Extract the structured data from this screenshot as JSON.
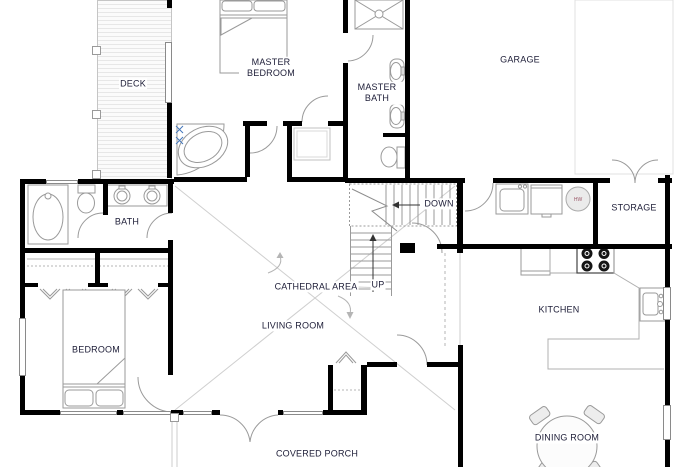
{
  "plan": {
    "type": "residential-floor-plan",
    "floor_labels": {
      "deck": "DECK",
      "master_bedroom": "MASTER BEDROOM",
      "master_bath": "MASTER BATH",
      "garage": "GARAGE",
      "bath": "BATH",
      "storage": "STORAGE",
      "down": "DOWN",
      "up": "UP",
      "cathedral_area": "CATHEDRAL AREA",
      "living_room": "LIVING ROOM",
      "bedroom": "BEDROOM",
      "kitchen": "KITCHEN",
      "dining_room": "DINING ROOM",
      "covered_porch": "COVERED PORCH",
      "water_heater": "HW"
    },
    "colors": {
      "wall": "#000000",
      "label_text": "#20203a",
      "thin_line": "#9a9a9a",
      "light_line": "#cccccc",
      "faucet_accent": "#4477bb",
      "water_heater_fill": "#ebebeb"
    },
    "fixtures": [
      "double-bed",
      "single-bed",
      "corner-tub",
      "bathtub",
      "shower",
      "toilet",
      "toilet",
      "double-sink-vanity",
      "oval-sink",
      "oval-sink",
      "washer",
      "dryer",
      "water-heater",
      "refrigerator",
      "range-4-burner",
      "kitchen-sink",
      "kitchen-counter",
      "dining-table",
      "dining-chairs",
      "stairs-down",
      "stairs-up",
      "bifold-closet-doors",
      "french-doors",
      "deck-boards"
    ]
  }
}
